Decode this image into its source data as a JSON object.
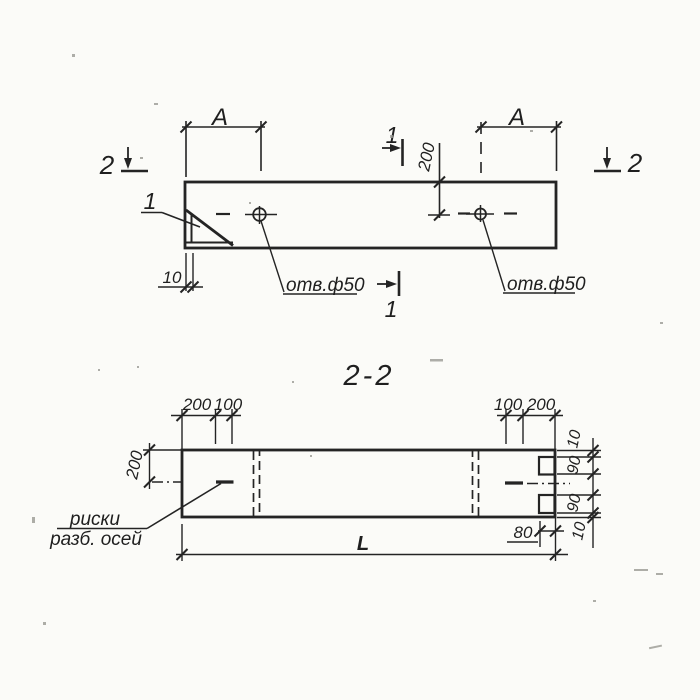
{
  "palette": {
    "paper": "#fbfbf8",
    "ink": "#242424",
    "faint": "#9a9a94"
  },
  "plan_view": {
    "section_marker_top": "1",
    "section_marker_bottom": "1",
    "section_marker_left": "2",
    "section_marker_right": "2",
    "detail_callout": "1",
    "dim_span_left": "A",
    "dim_span_right": "A",
    "dim_hole_offset": "200",
    "dim_edge_plate": "10",
    "hole_label_left": "отв.ф50",
    "hole_label_right": "отв.ф50"
  },
  "section_view": {
    "title": "2-2",
    "dim_top_left": [
      "200",
      "100"
    ],
    "dim_top_right": [
      "100",
      "200"
    ],
    "dim_height_half": "200",
    "dim_right_stack": [
      "10",
      "90",
      "90",
      "10"
    ],
    "dim_notch_depth": "80",
    "dim_length": "L",
    "axis_note_line1": "риски",
    "axis_note_line2": "разб. осей"
  }
}
